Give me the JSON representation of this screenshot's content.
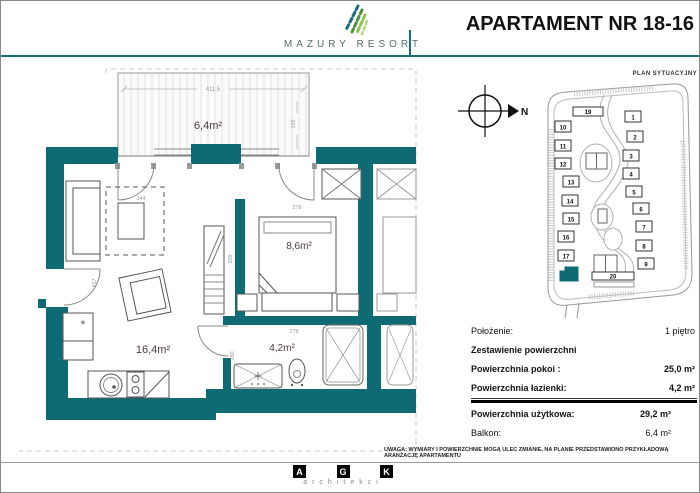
{
  "header": {
    "brand": "MAZURY RESORT",
    "title": "APARTAMENT NR 18-16"
  },
  "floor_plan": {
    "balcony_area": "6,4m²",
    "living_area": "16,4m²",
    "bedroom_area": "8,6m²",
    "bathroom_area": "4,2m²",
    "dims": {
      "balcony_w": "411.5",
      "balcony_h": "155",
      "living_dashed": "344",
      "living_left": "457",
      "bedroom_top": "278",
      "bedroom_left": "309",
      "bathroom_top": "278",
      "bathroom_left": "160"
    }
  },
  "site_plan": {
    "label": "PLAN SYTUACYJNY",
    "north": "N",
    "highlighted_building": "18",
    "buildings": [
      "1",
      "2",
      "3",
      "4",
      "5",
      "6",
      "7",
      "8",
      "9",
      "10",
      "11",
      "12",
      "13",
      "14",
      "15",
      "16",
      "17",
      "19",
      "20"
    ]
  },
  "table": {
    "rows": [
      {
        "label": "Położenie:",
        "value": "1 piętro"
      },
      {
        "label": "Zestawienie powierzchni",
        "value": ""
      },
      {
        "label": "Powierzchnia pokoi :",
        "value": "25,0 m²"
      },
      {
        "label": "Powierzchnia łazienki:",
        "value": "4,2 m²"
      },
      {
        "label": "Powierzchnia użytkowa:",
        "value": "29,2 m²"
      },
      {
        "label": "Balkon:",
        "value": "6,4 m²"
      }
    ]
  },
  "footer": {
    "disclaimer": "UWAGA: WYMIARY I POWIERZCHNIE MOGĄ ULEC ZMIANIE, NA PLANIE PRZEDSTAWIONO PRZYKŁADOWĄ ARANŻACJĘ APARTAMENTU",
    "logo_letters": [
      "A",
      "G",
      "K"
    ],
    "logo_sub": "architekci"
  },
  "colors": {
    "wall": "#0e6a73",
    "accent": "#157079"
  }
}
